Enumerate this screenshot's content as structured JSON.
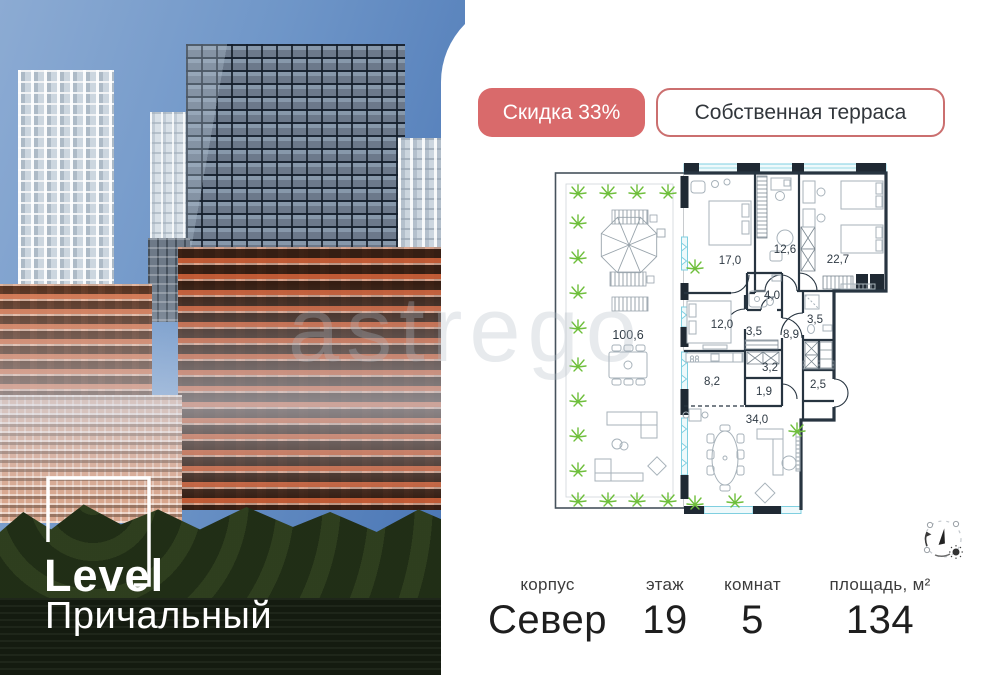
{
  "badges": {
    "discount": "Скидка 33%",
    "feature": "Собственная терраса"
  },
  "logo": {
    "line1": "Level",
    "line2": "Причальный"
  },
  "watermark": {
    "text": "astrego"
  },
  "floorplan": {
    "rooms": [
      {
        "id": "terrace",
        "area": "100,6"
      },
      {
        "id": "bedroom-1",
        "area": "17,0"
      },
      {
        "id": "study",
        "area": "12,6"
      },
      {
        "id": "bedroom-2",
        "area": "22,7"
      },
      {
        "id": "bathroom-1",
        "area": "4,0"
      },
      {
        "id": "bedroom-3",
        "area": "12,0"
      },
      {
        "id": "hall",
        "area": "3,5"
      },
      {
        "id": "corridor",
        "area": "8,9"
      },
      {
        "id": "bathroom-2",
        "area": "3,5"
      },
      {
        "id": "kitchen",
        "area": "8,2"
      },
      {
        "id": "laundry",
        "area": "3,2"
      },
      {
        "id": "wc",
        "area": "1,9"
      },
      {
        "id": "entry",
        "area": "2,5"
      },
      {
        "id": "living-room",
        "area": "34,0"
      }
    ]
  },
  "details": {
    "columns": [
      {
        "label": "корпус",
        "value": "Север"
      },
      {
        "label": "этаж",
        "value": "19"
      },
      {
        "label": "комнат",
        "value": "5"
      },
      {
        "label": "площадь, м²",
        "value": "134"
      }
    ]
  },
  "colors": {
    "accent_red": "#d96a6b",
    "glazing_teal": "#7fcfe0",
    "plan_wall": "#273440",
    "plant_green": "#6fbf3c",
    "sky_blue": "#5d87c1"
  }
}
